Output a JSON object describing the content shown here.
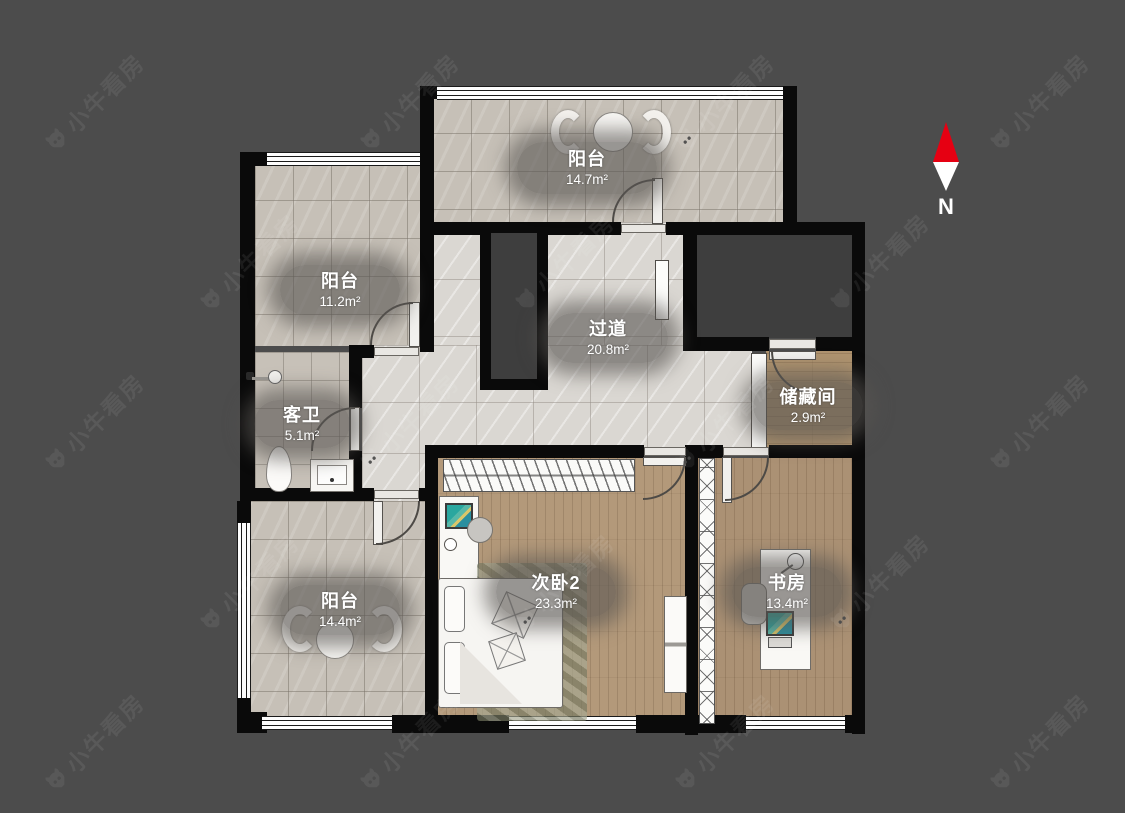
{
  "watermark": {
    "text": "小牛看房"
  },
  "compass": {
    "label": "N"
  },
  "rooms": {
    "balcony_top": {
      "name": "阳台",
      "area": "14.7m²"
    },
    "balcony_left": {
      "name": "阳台",
      "area": "11.2m²"
    },
    "hallway": {
      "name": "过道",
      "area": "20.8m²"
    },
    "guest_bath": {
      "name": "客卫",
      "area": "5.1m²"
    },
    "storage": {
      "name": "储藏间",
      "area": "2.9m²"
    },
    "bedroom2": {
      "name": "次卧2",
      "area": "23.3m²"
    },
    "study": {
      "name": "书房",
      "area": "13.4m²"
    },
    "balcony_bottom": {
      "name": "阳台",
      "area": "14.4m²"
    }
  },
  "colors": {
    "background": "#4c4c4c",
    "wall": "#0a0a0a",
    "north_arrow": "#e60012"
  }
}
